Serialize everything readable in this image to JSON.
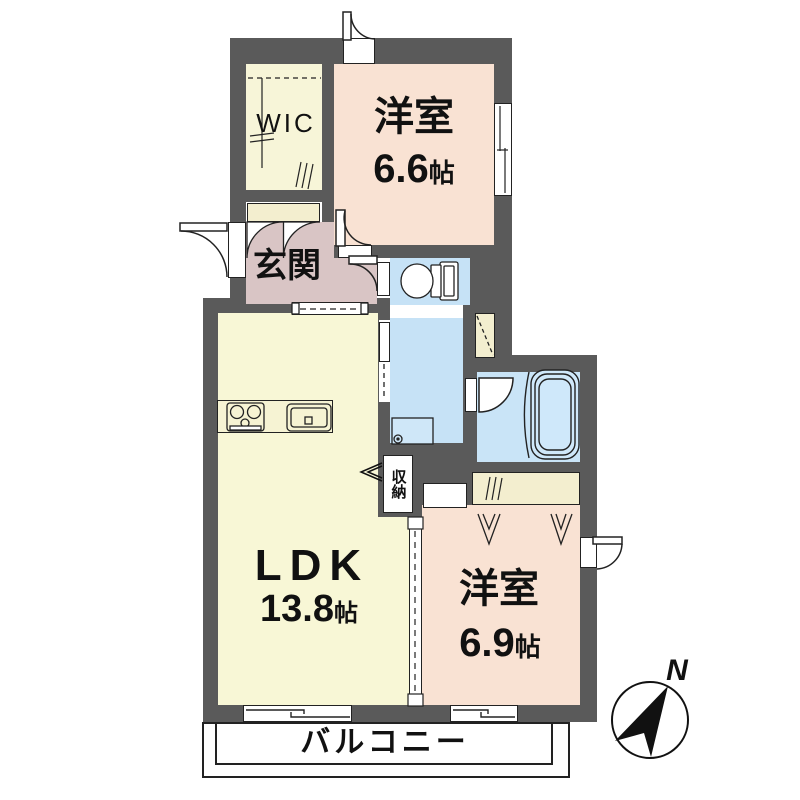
{
  "title": "apartment-floor-plan",
  "rooms": {
    "wic": {
      "label": "WIC"
    },
    "bedroom1": {
      "name": "洋室",
      "size": "6.6",
      "unit": "帖"
    },
    "genkan": {
      "label": "玄関"
    },
    "ldk": {
      "name": "LDK",
      "size": "13.8",
      "unit": "帖"
    },
    "storage": {
      "label": "収納"
    },
    "bedroom2": {
      "name": "洋室",
      "size": "6.9",
      "unit": "帖"
    },
    "balcony": {
      "label": "バルコニー"
    }
  },
  "compass": {
    "label": "N"
  },
  "colors": {
    "wall": "#5a5a5a",
    "bedroom_pink": "#f9e2d3",
    "ldk_yellow": "#f8f7d6",
    "wic_yellow": "#f7f5d8",
    "closet_cream": "#f3eecf",
    "genkan_mauve": "#d9c5c5",
    "wet_area_blue": "#c6e2f6",
    "bath_blue": "#c9e4f7",
    "line_black": "#222222"
  }
}
